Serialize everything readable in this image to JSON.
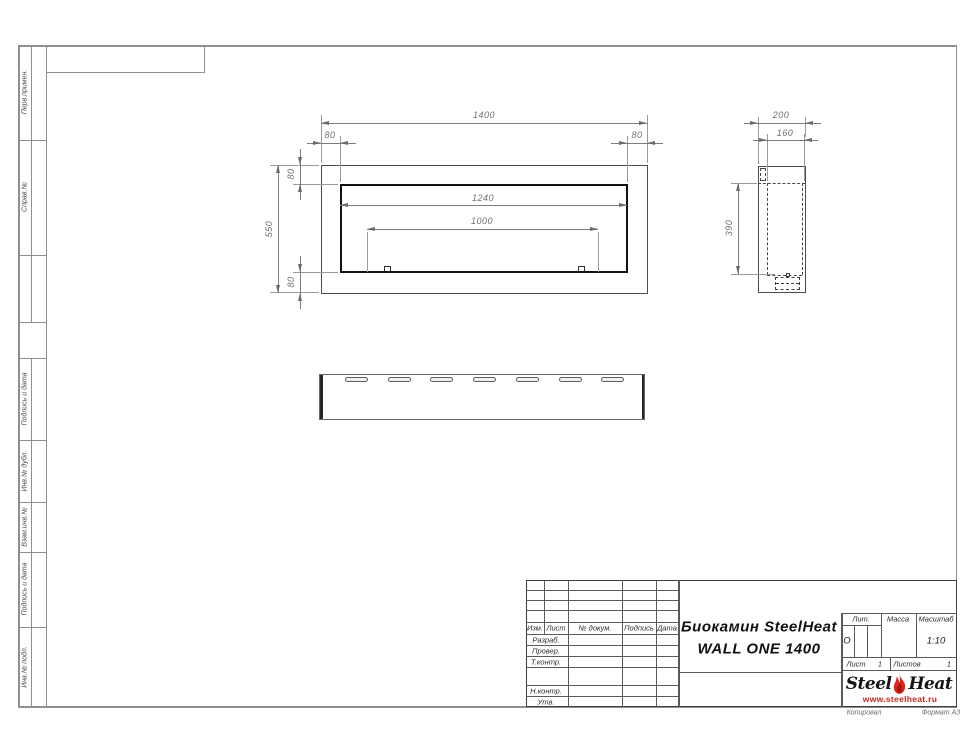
{
  "sheet": {
    "footer_left": "Копировал",
    "footer_right": "Формат А3"
  },
  "margin": {
    "labels": [
      "Перв.примен.",
      "Справ.№",
      "Подпись и дата",
      "Инв.№ дубл.",
      "Взам.инв.№",
      "Подпись и дата",
      "Инв.№ подл."
    ]
  },
  "views": {
    "front": {
      "dims": {
        "width": "1400",
        "height": "550",
        "left_inset": "80",
        "right_inset": "80",
        "top_inset": "80",
        "bottom_inset": "80",
        "opening_width": "1240",
        "burner_width": "1000"
      }
    },
    "side": {
      "dims": {
        "depth": "200",
        "inner_depth": "160",
        "opening_height": "390"
      }
    },
    "bottom": {
      "slot_count": 7
    }
  },
  "title_block": {
    "header_cols": [
      "Изм.",
      "Лист",
      "№ докум.",
      "Подпись",
      "Дата"
    ],
    "row_labels": [
      "Разраб.",
      "Провер.",
      "Т.контр.",
      "Н.контр.",
      "Утв."
    ],
    "title_line1": "Биокамин SteelHeat",
    "title_line2": "WALL ONE 1400",
    "lit_label": "Лит.",
    "lit_value": "О",
    "massa_label": "Масса",
    "masshtab_label": "Масштаб",
    "masshtab_value": "1:10",
    "list_label": "Лист",
    "list_value": "1",
    "listov_label": "Листов",
    "listov_value": "1",
    "logo": {
      "steel": "Steel",
      "heat": "Heat",
      "site": "www.steelheat.ru",
      "flame_color": "#e2231a",
      "flame_inner_color": "#a31510"
    }
  }
}
